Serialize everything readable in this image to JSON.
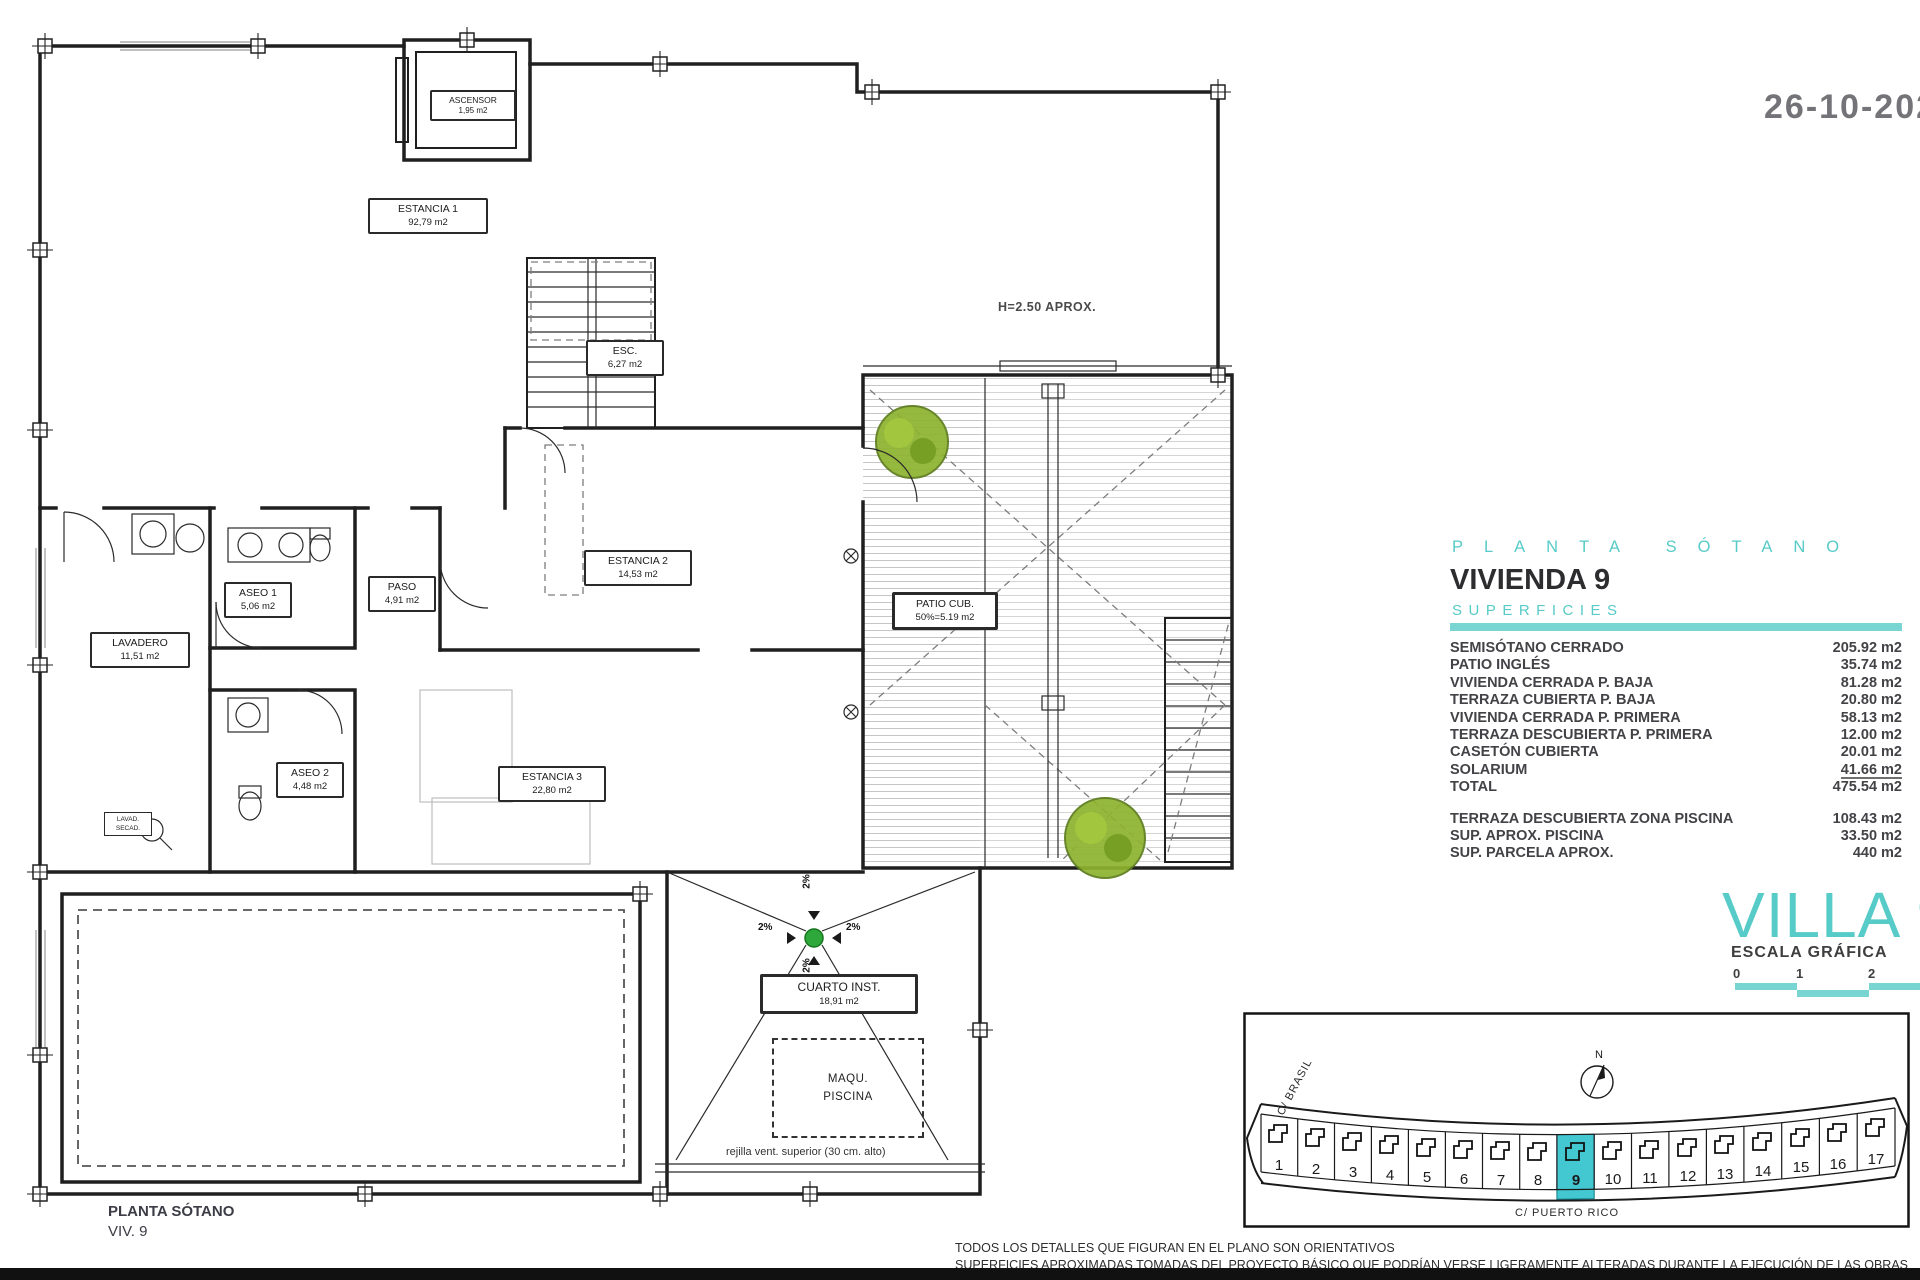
{
  "colors": {
    "teal": "#57cbc7",
    "tealBar": "#79d5d1",
    "highlight": "#43c7d1",
    "treeGreen": "#8db32e",
    "drainGreen": "#2ea83a"
  },
  "date": "26-10-202",
  "panel": {
    "plan_title": "PLANTA SÓTANO",
    "vivienda": "VIVIENDA 9",
    "superficies_label": "SUPERFICIES",
    "rows": [
      {
        "label": "SEMISÓTANO CERRADO",
        "value": "205.92 m2"
      },
      {
        "label": "PATIO INGLÉS",
        "value": "35.74 m2"
      },
      {
        "label": "VIVIENDA CERRADA P. BAJA",
        "value": "81.28 m2"
      },
      {
        "label": "TERRAZA CUBIERTA P. BAJA",
        "value": "20.80 m2"
      },
      {
        "label": "VIVIENDA CERRADA P. PRIMERA",
        "value": "58.13 m2"
      },
      {
        "label": "TERRAZA DESCUBIERTA P. PRIMERA",
        "value": "12.00 m2"
      },
      {
        "label": "CASETÓN CUBIERTA",
        "value": "20.01 m2"
      },
      {
        "label": "SOLARIUM",
        "value": "41.66 m2"
      },
      {
        "label": "TOTAL",
        "value": "475.54 m2"
      }
    ],
    "extra_rows": [
      {
        "label": "TERRAZA DESCUBIERTA  ZONA PISCINA",
        "value": "108.43 m2"
      },
      {
        "label": "SUP.  APROX.  PISCINA",
        "value": "33.50 m2"
      },
      {
        "label": "SUP. PARCELA APROX.",
        "value": "440 m2"
      }
    ],
    "villa_title": "VILLA 9",
    "escala_label": "ESCALA GRÁFICA",
    "scale_ticks": [
      "0",
      "1",
      "2"
    ]
  },
  "plan": {
    "rooms": [
      {
        "name": "ESTANCIA 1",
        "area": "92,79 m2"
      },
      {
        "name": "ASCENSOR",
        "area": "1,95 m2"
      },
      {
        "name": "ESC.",
        "area": "6,27 m2"
      },
      {
        "name": "ASEO 1",
        "area": "5,06 m2"
      },
      {
        "name": "PASO",
        "area": "4,91 m2"
      },
      {
        "name": "LAVADERO",
        "area": "11,51 m2"
      },
      {
        "name": "ESTANCIA 2",
        "area": "14,53 m2"
      },
      {
        "name": "ASEO 2",
        "area": "4,48 m2"
      },
      {
        "name": "ESTANCIA 3",
        "area": "22,80 m2"
      },
      {
        "name": "PATIO CUB.",
        "area": "50%=5.19 m2"
      },
      {
        "name": "CUARTO INST.",
        "area": "18,91 m2"
      },
      {
        "name": "MAQU.",
        "area": "PISCINA"
      }
    ],
    "h_label": "H=2.50 APROX.",
    "rejilla": "rejilla vent. superior (30 cm. alto)",
    "slope": "2%",
    "tiny": {
      "line1": "LAVAD.",
      "line2": "SECAD."
    },
    "footer_line1": "PLANTA SÓTANO",
    "footer_line2": "VIV. 9"
  },
  "siteplan": {
    "north_label": "N",
    "street_bottom": "C/ PUERTO RICO",
    "street_left": "C/ BRASIL",
    "plots": [
      "1",
      "2",
      "3",
      "4",
      "5",
      "6",
      "7",
      "8",
      "9",
      "10",
      "11",
      "12",
      "13",
      "14",
      "15",
      "16",
      "17"
    ],
    "highlighted_plot": "9"
  },
  "disclaimer": {
    "line1": "TODOS LOS DETALLES QUE FIGURAN EN EL PLANO SON ORIENTATIVOS",
    "line2": "SUPERFICIES APROXIMADAS TOMADAS DEL PROYECTO BÁSICO QUE PODRÍAN VERSE LIGERAMENTE ALTERADAS DURANTE LA EJECUCIÓN DE LAS OBRAS"
  }
}
